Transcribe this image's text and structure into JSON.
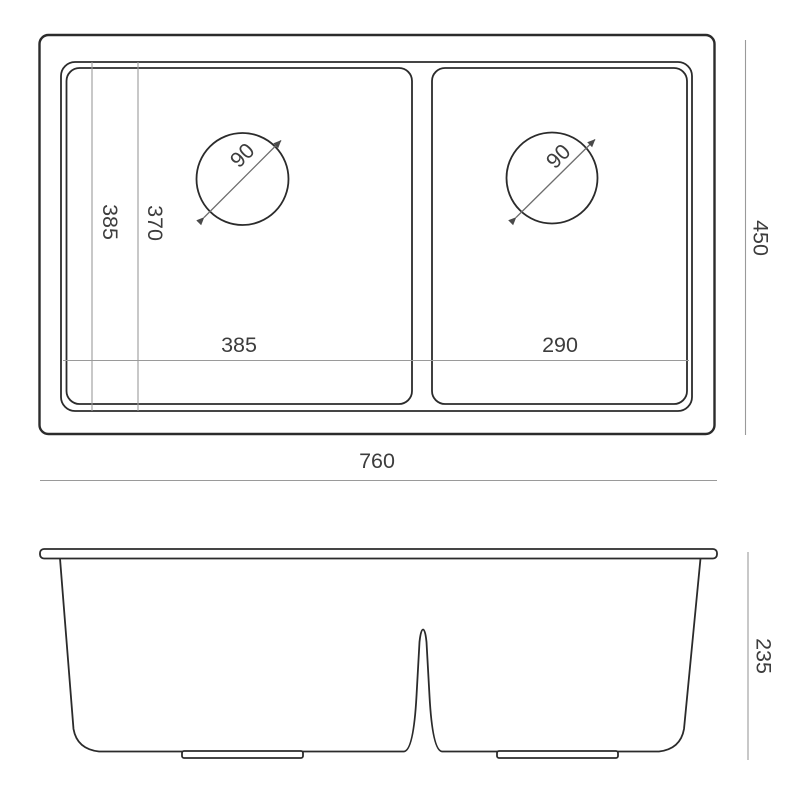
{
  "colors": {
    "line": "#2b2b2b",
    "dimension_line": "#9a9a9a",
    "text": "#3d3d3d",
    "background": "#ffffff"
  },
  "top_view": {
    "labels": {
      "bowl_inner_depth": "385",
      "bowl_inner_depth_secondary": "370",
      "left_bowl_width": "385",
      "right_bowl_width": "290",
      "left_drain_diameter": "90",
      "right_drain_diameter": "90",
      "overall_width": "760",
      "overall_depth": "450"
    }
  },
  "front_view": {
    "labels": {
      "overall_height": "235"
    }
  }
}
